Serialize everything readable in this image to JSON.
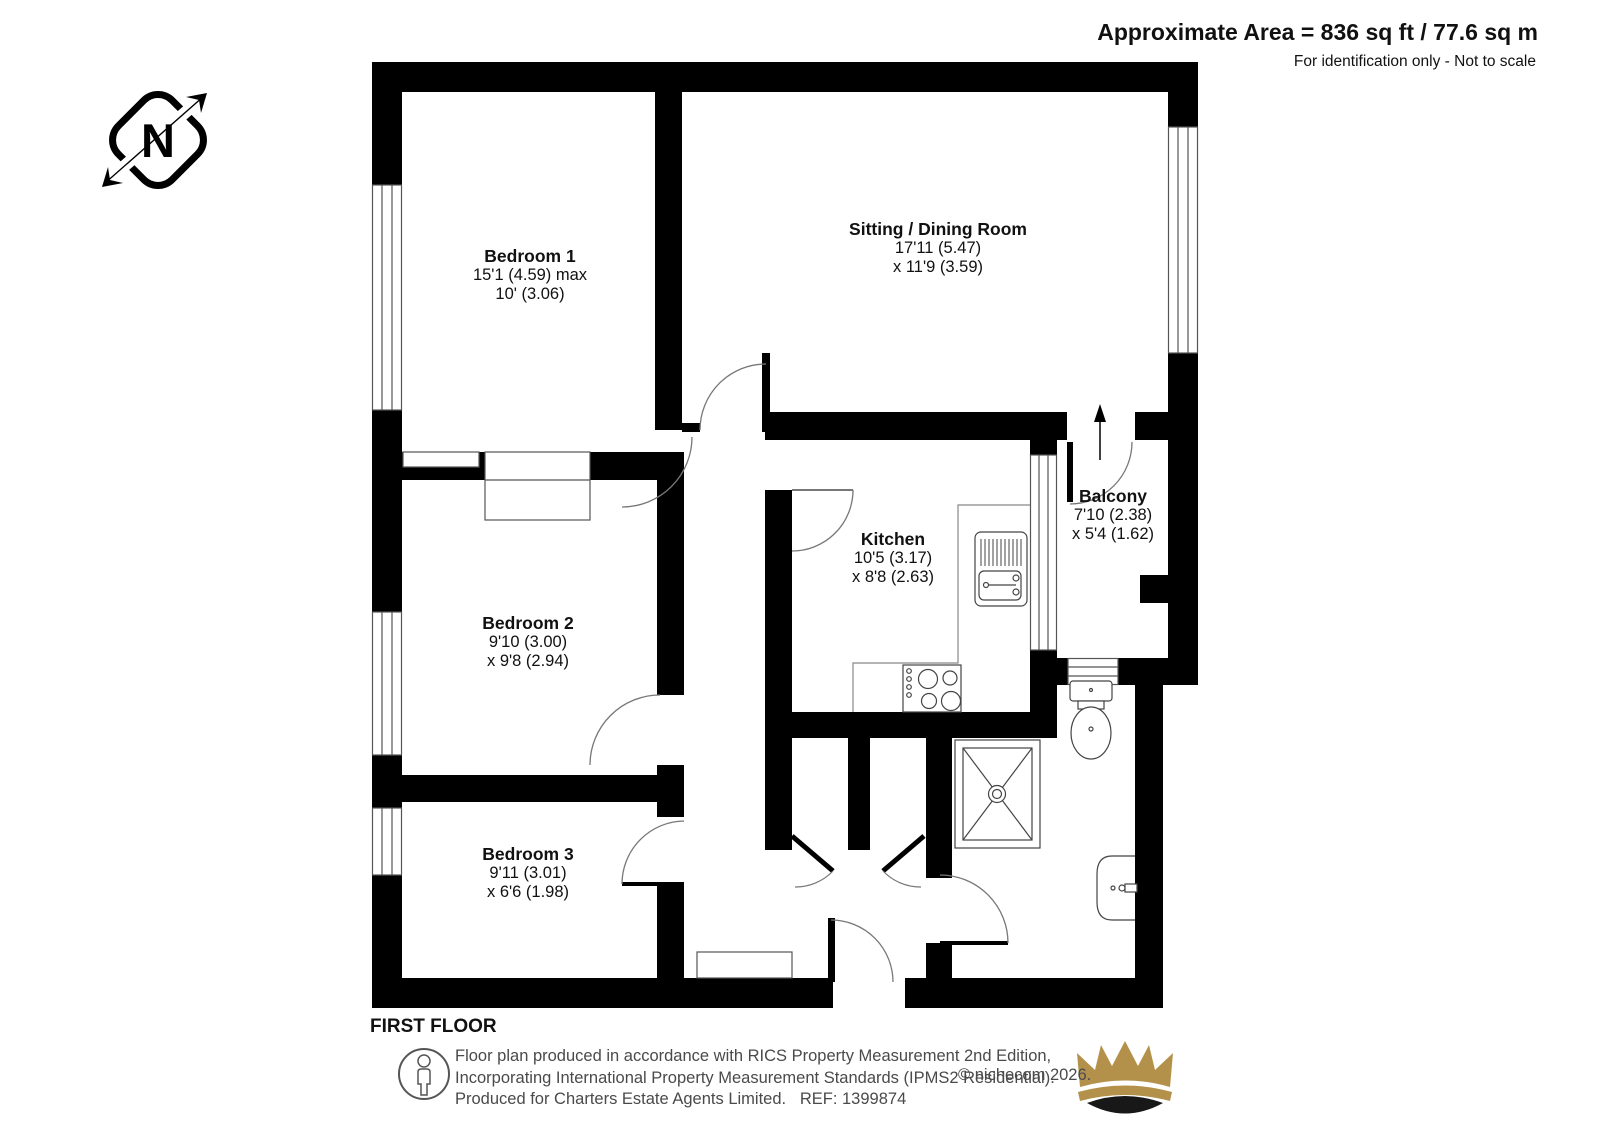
{
  "header": {
    "area": "Approximate Area = 836 sq ft / 77.6 sq m",
    "note": "For identification only - Not to scale"
  },
  "compass": {
    "letter": "N"
  },
  "rooms": [
    {
      "name": "Bedroom 1",
      "dim1": "15'1 (4.59) max",
      "dim2": "10' (3.06)"
    },
    {
      "name": "Sitting / Dining Room",
      "dim1": "17'11 (5.47)",
      "dim2": "x 11'9 (3.59)"
    },
    {
      "name": "Kitchen",
      "dim1": "10'5 (3.17)",
      "dim2": "x 8'8 (2.63)"
    },
    {
      "name": "Balcony",
      "dim1": "7'10 (2.38)",
      "dim2": "x 5'4 (1.62)"
    },
    {
      "name": "Bedroom 2",
      "dim1": "9'10 (3.00)",
      "dim2": "x 9'8 (2.94)"
    },
    {
      "name": "Bedroom 3",
      "dim1": "9'11 (3.01)",
      "dim2": "x 6'6 (1.98)"
    }
  ],
  "floor_label": "FIRST FLOOR",
  "footer": {
    "line1": "Floor plan produced in accordance with RICS Property Measurement 2nd Edition,",
    "line2": "Incorporating International Property Measurement Standards (IPMS2 Residential).",
    "line3": "Produced for Charters Estate Agents Limited.   REF: 1399874",
    "copyright": "© nichecom 2026."
  },
  "colors": {
    "wall": "#000000",
    "thin_line": "#777777",
    "crown_gold": "#b3914a",
    "crown_dark": "#181818"
  }
}
